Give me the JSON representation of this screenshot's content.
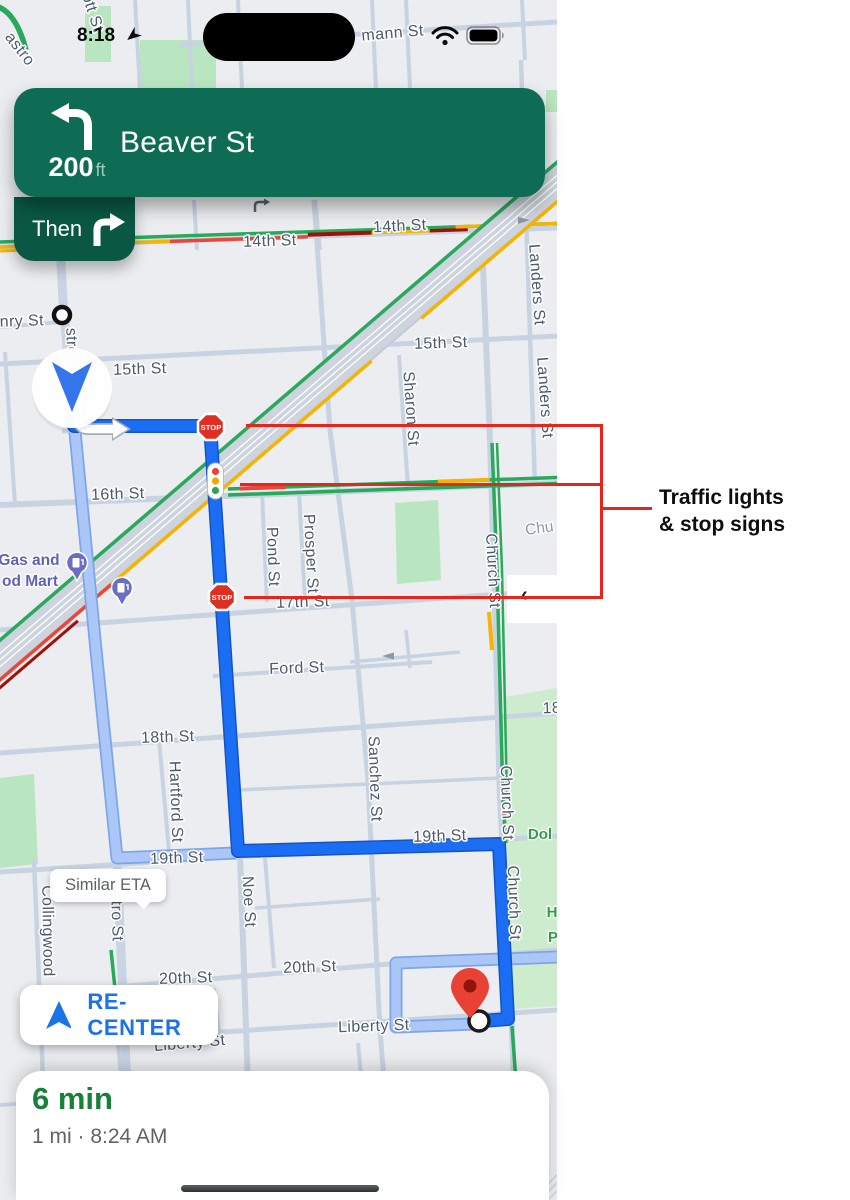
{
  "status_bar": {
    "time": "8:18"
  },
  "nav_banner": {
    "distance": "200",
    "distance_unit": "ft",
    "instruction": "Beaver St",
    "then_label": "Then"
  },
  "map": {
    "street_labels": [
      "14th St",
      "14th St",
      "15th St",
      "15th St",
      "16th St",
      "17th St",
      "Ford St",
      "18th St",
      "18",
      "19th St",
      "19th St",
      "20th St",
      "20th St",
      "Liberty St",
      "Liberty St",
      "nry St",
      "mann St",
      "ott St",
      "astro",
      "stro S",
      "stro St",
      "Collingwood",
      "Noe St",
      "Hartford St",
      "Sanchez St",
      "Pond St",
      "Prosper St",
      "Sharon St",
      "Landers St",
      "Landers St",
      "Church St",
      "Church St",
      "Church St"
    ],
    "poi_labels": [
      "Gas and",
      "od Mart",
      "Chu",
      "Dol",
      "H",
      "P"
    ],
    "stop_sign": "STOP",
    "similar_eta": "Similar ETA",
    "recenter": "RE-CENTER",
    "edge_chevron": "‹"
  },
  "annotation": {
    "line1": "Traffic lights",
    "line2": "& stop signs"
  },
  "bottom_sheet": {
    "duration": "6 min",
    "details": "1 mi · 8:24 AM"
  },
  "colors": {
    "nav_green": "#0e6b54",
    "then_green": "#0a5844",
    "route_blue": "#1b6ef3",
    "alt_route_blue": "#a5c4f7",
    "annotation_red": "#e8251d",
    "eta_green": "#188038",
    "recenter_blue": "#1a73e8",
    "traffic_green": "#28a95c",
    "traffic_yellow": "#f4b400",
    "traffic_red": "#e8483c",
    "stop_red": "#df2f23"
  }
}
